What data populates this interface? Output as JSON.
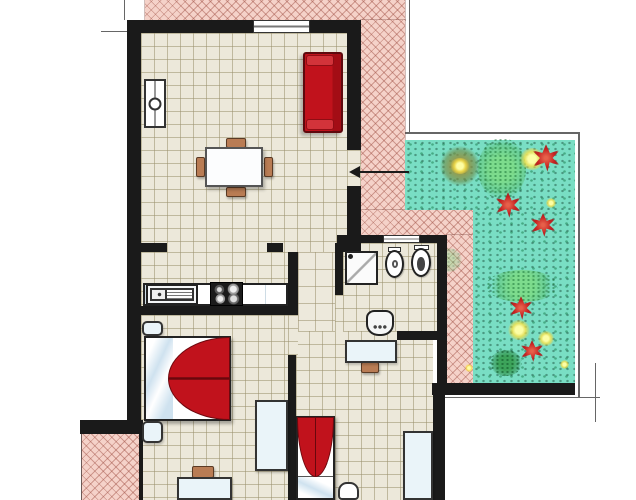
{
  "meta": {
    "title": "Apartment floor plan with terrace and garden",
    "canvas": {
      "w": 636,
      "h": 500
    }
  },
  "palette": {
    "wall": "#1a1a1a",
    "floor": "#ece8da",
    "floor2": "#ede9dc",
    "grid": "rgba(155,145,110,0.55)",
    "terrace": "#f5d2c9",
    "hatch": "rgba(158,78,66,0.45)",
    "garden": "#79dec4",
    "red": "#c1121c",
    "red-dark": "#6e090f",
    "wood": "#b97c54"
  },
  "elements": [
    {
      "name": "plot-extension-line-top-left-v",
      "cls": "tline",
      "x": 124,
      "y": 0,
      "w": 1,
      "h": 20
    },
    {
      "name": "plot-extension-line-top-left-h",
      "cls": "tline",
      "x": 101,
      "y": 31,
      "w": 28,
      "h": 1
    },
    {
      "name": "window-extension-line",
      "cls": "tline",
      "x": 206,
      "y": 33,
      "w": 1,
      "h": 14
    },
    {
      "name": "plot-boundary-right-v",
      "cls": "tline",
      "x": 409,
      "y": 0,
      "w": 1,
      "h": 132
    },
    {
      "name": "garden-border-top",
      "cls": "tline",
      "x": 402,
      "y": 132,
      "w": 178,
      "h": 2
    },
    {
      "name": "garden-border-right",
      "cls": "tline",
      "x": 578,
      "y": 132,
      "w": 2,
      "h": 265
    },
    {
      "name": "garden-extension-line-h",
      "cls": "tline",
      "x": 440,
      "y": 397,
      "w": 160,
      "h": 1
    },
    {
      "name": "garden-extension-line-v",
      "cls": "tline",
      "x": 595,
      "y": 363,
      "w": 1,
      "h": 59
    },
    {
      "name": "entrance-section-line-v",
      "cls": "tline",
      "x": 317,
      "y": 222,
      "w": 1,
      "h": 36
    },
    {
      "name": "entrance-section-line-h",
      "cls": "tline",
      "x": 301,
      "y": 247,
      "w": 34,
      "h": 1
    },
    {
      "name": "terrace-sw-edge-line",
      "cls": "tline",
      "x": 81,
      "y": 433,
      "w": 1,
      "h": 67
    },
    {
      "name": "terrace-north-strip",
      "cls": "terrace",
      "x": 145,
      "y": 0,
      "w": 260,
      "h": 20
    },
    {
      "name": "terrace-east-band",
      "cls": "terrace",
      "x": 361,
      "y": 20,
      "w": 44,
      "h": 190
    },
    {
      "name": "terrace-connector",
      "cls": "terrace",
      "x": 361,
      "y": 210,
      "w": 112,
      "h": 25
    },
    {
      "name": "terrace-garden-strip",
      "cls": "terrace",
      "x": 447,
      "y": 235,
      "w": 26,
      "h": 148
    },
    {
      "name": "terrace-southwest",
      "cls": "terrace",
      "x": 82,
      "y": 434,
      "w": 60,
      "h": 66
    },
    {
      "name": "garden-upper",
      "cls": "garden",
      "x": 405,
      "y": 140,
      "w": 170,
      "h": 70
    },
    {
      "name": "garden-lower",
      "cls": "garden",
      "x": 473,
      "y": 210,
      "w": 102,
      "h": 173
    },
    {
      "name": "garden-bush-olive-1",
      "cls": "bush-olive",
      "x": 440,
      "y": 146,
      "w": 40,
      "h": 40
    },
    {
      "name": "garden-bush-light-1",
      "cls": "bush-light",
      "x": 478,
      "y": 138,
      "w": 48,
      "h": 62
    },
    {
      "name": "garden-glow-1",
      "cls": "glow",
      "x": 520,
      "y": 148,
      "w": 24,
      "h": 22
    },
    {
      "name": "garden-flower-1",
      "cls": "flower",
      "x": 531,
      "y": 144,
      "w": 30,
      "h": 28
    },
    {
      "name": "garden-flower-2",
      "cls": "flower",
      "x": 494,
      "y": 192,
      "w": 28,
      "h": 26
    },
    {
      "name": "garden-yellow-dot-1",
      "cls": "glow",
      "x": 546,
      "y": 198,
      "w": 10,
      "h": 10
    },
    {
      "name": "garden-flower-3",
      "cls": "flower",
      "x": 529,
      "y": 213,
      "w": 28,
      "h": 24
    },
    {
      "name": "garden-bush-faint",
      "cls": "bush-light faint",
      "x": 436,
      "y": 248,
      "w": 26,
      "h": 24
    },
    {
      "name": "garden-bush-light-2",
      "cls": "bush-light",
      "x": 486,
      "y": 270,
      "w": 72,
      "h": 32
    },
    {
      "name": "garden-flower-4",
      "cls": "flower",
      "x": 508,
      "y": 296,
      "w": 26,
      "h": 24
    },
    {
      "name": "garden-glow-2",
      "cls": "glow",
      "x": 508,
      "y": 320,
      "w": 22,
      "h": 20
    },
    {
      "name": "garden-glow-3",
      "cls": "glow",
      "x": 538,
      "y": 331,
      "w": 16,
      "h": 15
    },
    {
      "name": "garden-flower-5",
      "cls": "flower",
      "x": 519,
      "y": 340,
      "w": 26,
      "h": 22
    },
    {
      "name": "garden-bush-dark-1",
      "cls": "bush-dark",
      "x": 490,
      "y": 350,
      "w": 32,
      "h": 26
    },
    {
      "name": "garden-yellow-dot-2",
      "cls": "glow",
      "x": 560,
      "y": 360,
      "w": 9,
      "h": 9
    },
    {
      "name": "garden-glow-olive-center",
      "cls": "glow",
      "x": 450,
      "y": 158,
      "w": 20,
      "h": 16
    },
    {
      "name": "garden-yellow-dot-3",
      "cls": "glow",
      "x": 465,
      "y": 364,
      "w": 8,
      "h": 8
    },
    {
      "name": "living-room-floor",
      "cls": "floor",
      "x": 141,
      "y": 33,
      "w": 206,
      "h": 219
    },
    {
      "name": "kitchen-floor",
      "cls": "floor",
      "x": 141,
      "y": 252,
      "w": 147,
      "h": 54
    },
    {
      "name": "corridor-floor",
      "cls": "floor-lg",
      "x": 298,
      "y": 252,
      "w": 37,
      "h": 81
    },
    {
      "name": "bathroom-floor",
      "cls": "floor",
      "x": 343,
      "y": 243,
      "w": 94,
      "h": 88
    },
    {
      "name": "bedroom1-floor",
      "cls": "floor",
      "x": 141,
      "y": 315,
      "w": 147,
      "h": 185
    },
    {
      "name": "bedroom2-floor",
      "cls": "floor",
      "x": 296,
      "y": 331,
      "w": 137,
      "h": 169
    },
    {
      "name": "terrace-door-opening",
      "cls": "floor",
      "x": 347,
      "y": 150,
      "w": 14,
      "h": 36
    },
    {
      "name": "bedroom1-door-opening",
      "cls": "floor",
      "x": 288,
      "y": 315,
      "w": 10,
      "h": 40
    },
    {
      "name": "bathroom-door-opening",
      "cls": "floor",
      "x": 335,
      "y": 295,
      "w": 8,
      "h": 38
    },
    {
      "name": "wall-north",
      "cls": "wall",
      "x": 127,
      "y": 20,
      "w": 234,
      "h": 13
    },
    {
      "name": "wall-west",
      "cls": "wall",
      "x": 127,
      "y": 20,
      "w": 14,
      "h": 413
    },
    {
      "name": "wall-east-upper",
      "cls": "wall",
      "x": 347,
      "y": 20,
      "w": 14,
      "h": 130
    },
    {
      "name": "wall-east-mid",
      "cls": "wall",
      "x": 347,
      "y": 186,
      "w": 14,
      "h": 57
    },
    {
      "name": "wall-living-divider-a",
      "cls": "wall",
      "x": 127,
      "y": 243,
      "w": 40,
      "h": 9
    },
    {
      "name": "wall-living-divider-b",
      "cls": "wall",
      "x": 267,
      "y": 243,
      "w": 16,
      "h": 9
    },
    {
      "name": "wall-living-divider-c",
      "cls": "wall",
      "x": 337,
      "y": 243,
      "w": 24,
      "h": 9
    },
    {
      "name": "wall-bathroom-top-a",
      "cls": "wall",
      "x": 337,
      "y": 235,
      "w": 46,
      "h": 8
    },
    {
      "name": "wall-bathroom-top-b",
      "cls": "wall",
      "x": 420,
      "y": 235,
      "w": 27,
      "h": 8
    },
    {
      "name": "wall-kitchen-corridor",
      "cls": "wall",
      "x": 288,
      "y": 252,
      "w": 10,
      "h": 61
    },
    {
      "name": "wall-kitchen-bedroom1",
      "cls": "wall",
      "x": 127,
      "y": 306,
      "w": 171,
      "h": 9
    },
    {
      "name": "wall-bedroom1-corridor",
      "cls": "wall",
      "x": 288,
      "y": 355,
      "w": 8,
      "h": 145
    },
    {
      "name": "wall-bathroom-left",
      "cls": "wall",
      "x": 335,
      "y": 243,
      "w": 8,
      "h": 52
    },
    {
      "name": "wall-bathroom-right",
      "cls": "wall",
      "x": 437,
      "y": 235,
      "w": 10,
      "h": 148
    },
    {
      "name": "wall-bathroom-bottom",
      "cls": "wall",
      "x": 397,
      "y": 331,
      "w": 50,
      "h": 9
    },
    {
      "name": "wall-garden-south",
      "cls": "wall",
      "x": 432,
      "y": 383,
      "w": 143,
      "h": 12
    },
    {
      "name": "wall-bedroom2-right",
      "cls": "wall",
      "x": 433,
      "y": 395,
      "w": 12,
      "h": 105
    },
    {
      "name": "wall-terrace-sw-top",
      "cls": "wall",
      "x": 80,
      "y": 420,
      "w": 63,
      "h": 14
    },
    {
      "name": "wall-terrace-sw-right",
      "cls": "wall",
      "x": 139,
      "y": 434,
      "w": 4,
      "h": 66
    },
    {
      "name": "living-room-window",
      "cls": "window",
      "x": 253,
      "y": 20,
      "w": 57,
      "h": 13
    },
    {
      "name": "bathroom-window",
      "cls": "window",
      "x": 383,
      "y": 235,
      "w": 37,
      "h": 8
    },
    {
      "name": "radiator",
      "cls": "radiator",
      "x": 144,
      "y": 79,
      "w": 22,
      "h": 49
    },
    {
      "name": "sofa",
      "cls": "sofa",
      "x": 303,
      "y": 52,
      "w": 40,
      "h": 81
    },
    {
      "name": "dining-chair-north",
      "cls": "chair",
      "x": 226,
      "y": 138,
      "w": 20,
      "h": 10
    },
    {
      "name": "dining-chair-south",
      "cls": "chair",
      "x": 226,
      "y": 187,
      "w": 20,
      "h": 10
    },
    {
      "name": "dining-chair-west",
      "cls": "chair",
      "x": 196,
      "y": 157,
      "w": 9,
      "h": 20
    },
    {
      "name": "dining-chair-east",
      "cls": "chair",
      "x": 264,
      "y": 157,
      "w": 9,
      "h": 20
    },
    {
      "name": "dining-table",
      "cls": "table",
      "x": 205,
      "y": 147,
      "w": 58,
      "h": 40
    },
    {
      "name": "kitchen-counter",
      "cls": "counter",
      "x": 143,
      "y": 283,
      "w": 145,
      "h": 23
    },
    {
      "name": "kitchen-sink",
      "cls": "sink",
      "x": 146,
      "y": 284,
      "w": 52,
      "h": 21
    },
    {
      "name": "stove",
      "cls": "stove",
      "x": 210,
      "y": 282,
      "w": 33,
      "h": 24
    },
    {
      "name": "shower",
      "cls": "shower",
      "x": 345,
      "y": 251,
      "w": 33,
      "h": 34
    },
    {
      "name": "bidet-tank",
      "cls": "tank",
      "x": 388,
      "y": 247,
      "w": 13,
      "h": 5
    },
    {
      "name": "bidet",
      "cls": "oval bidet",
      "x": 385,
      "y": 250,
      "w": 19,
      "h": 28
    },
    {
      "name": "toilet-tank",
      "cls": "tank",
      "x": 414,
      "y": 245,
      "w": 15,
      "h": 5
    },
    {
      "name": "toilet",
      "cls": "oval toilet",
      "x": 411,
      "y": 248,
      "w": 20,
      "h": 29
    },
    {
      "name": "washbasin",
      "cls": "basin",
      "x": 366,
      "y": 310,
      "w": 28,
      "h": 26
    },
    {
      "name": "bedroom1-nightstand-top",
      "cls": "unit rounded",
      "x": 142,
      "y": 321,
      "w": 21,
      "h": 15
    },
    {
      "name": "double-bed",
      "cls": "bed-double",
      "x": 144,
      "y": 336,
      "w": 87,
      "h": 85
    },
    {
      "name": "bedroom1-nightstand-bottom",
      "cls": "unit rounded",
      "x": 142,
      "y": 421,
      "w": 21,
      "h": 22
    },
    {
      "name": "bedroom1-wardrobe",
      "cls": "unit",
      "x": 255,
      "y": 400,
      "w": 33,
      "h": 71
    },
    {
      "name": "bedroom1-desk-chair",
      "cls": "chair",
      "x": 192,
      "y": 466,
      "w": 22,
      "h": 12
    },
    {
      "name": "bedroom1-desk",
      "cls": "unit",
      "x": 177,
      "y": 477,
      "w": 55,
      "h": 23
    },
    {
      "name": "bedroom2-desk-chair",
      "cls": "chair",
      "x": 361,
      "y": 362,
      "w": 18,
      "h": 11
    },
    {
      "name": "bedroom2-desk",
      "cls": "unit",
      "x": 345,
      "y": 340,
      "w": 52,
      "h": 23
    },
    {
      "name": "single-bed",
      "cls": "bed-single",
      "x": 296,
      "y": 416,
      "w": 39,
      "h": 84
    },
    {
      "name": "bedroom2-stool",
      "cls": "stool",
      "x": 338,
      "y": 482,
      "w": 21,
      "h": 18
    },
    {
      "name": "bedroom2-wardrobe",
      "cls": "unit",
      "x": 403,
      "y": 431,
      "w": 30,
      "h": 69
    },
    {
      "name": "entrance-arrow-line",
      "cls": "aline",
      "x": 354,
      "y": 171,
      "w": 55,
      "h": 2
    },
    {
      "name": "entrance-arrow-head",
      "cls": "ahead",
      "x": 349,
      "y": 166,
      "w": 11,
      "h": 12
    }
  ]
}
